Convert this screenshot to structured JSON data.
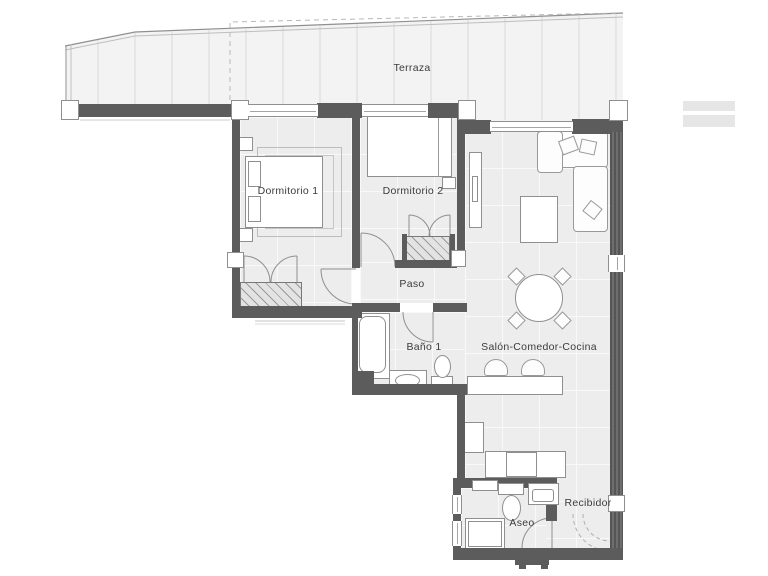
{
  "plan": {
    "type": "apartment-floor-plan",
    "rooms": {
      "terraza": {
        "label": "Terraza"
      },
      "dormitorio1": {
        "label": "Dormitorio 1"
      },
      "dormitorio2": {
        "label": "Dormitorio 2"
      },
      "paso": {
        "label": "Paso"
      },
      "bano1": {
        "label": "Baño 1"
      },
      "salon": {
        "label": "Salón-Comedor-Cocina"
      },
      "aseo": {
        "label": "Aseo"
      },
      "recibidor": {
        "label": "Recibidor"
      }
    },
    "colors": {
      "wall": "#5c5c5c",
      "floor": "#ededed",
      "terrace_floor": "#f3f3f3",
      "linework": "#8f8f8f",
      "label_text": "#3b3b3b",
      "background": "#ffffff"
    }
  }
}
